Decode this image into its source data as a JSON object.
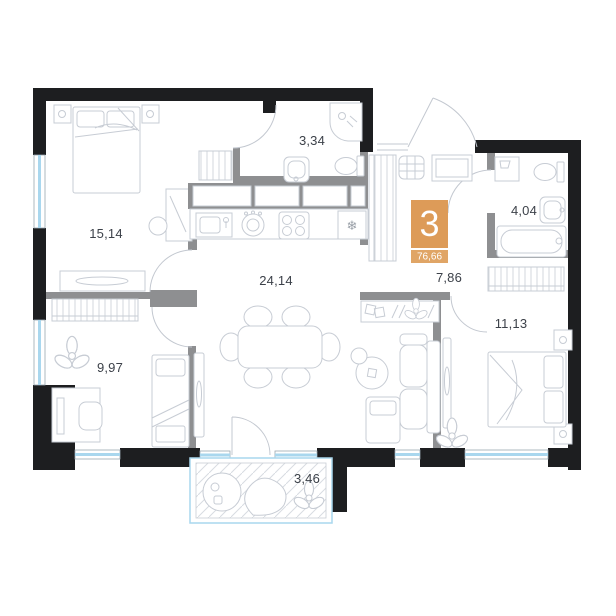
{
  "plan": {
    "type": "apartment-floor-plan",
    "badge": {
      "rooms_number": "3",
      "total_area": "76,66"
    },
    "rooms": [
      {
        "name": "bedroom-main",
        "area": "15,14"
      },
      {
        "name": "bathroom-guest",
        "area": "3,34"
      },
      {
        "name": "bathroom-main",
        "area": "4,04"
      },
      {
        "name": "kitchen-living-room",
        "area": "24,14"
      },
      {
        "name": "hallway",
        "area": "7,86"
      },
      {
        "name": "room-second",
        "area": "9,97"
      },
      {
        "name": "bedroom-second",
        "area": "11,13"
      },
      {
        "name": "balcony",
        "area": "3,46"
      }
    ],
    "icons": {
      "fridge_snowflake": "❄"
    },
    "colors": {
      "exterior_wall": "#1d1e20",
      "interior_wall": "#8e8f91",
      "furniture_outline": "#c7ccd4",
      "window_glass": "#a9d7ee",
      "label_text": "#3c4149",
      "badge_orange": "#dd9b58",
      "badge_orange_light": "#e0a566",
      "badge_text": "#ffffff",
      "balcony_hatch": "#d8dce1"
    }
  }
}
